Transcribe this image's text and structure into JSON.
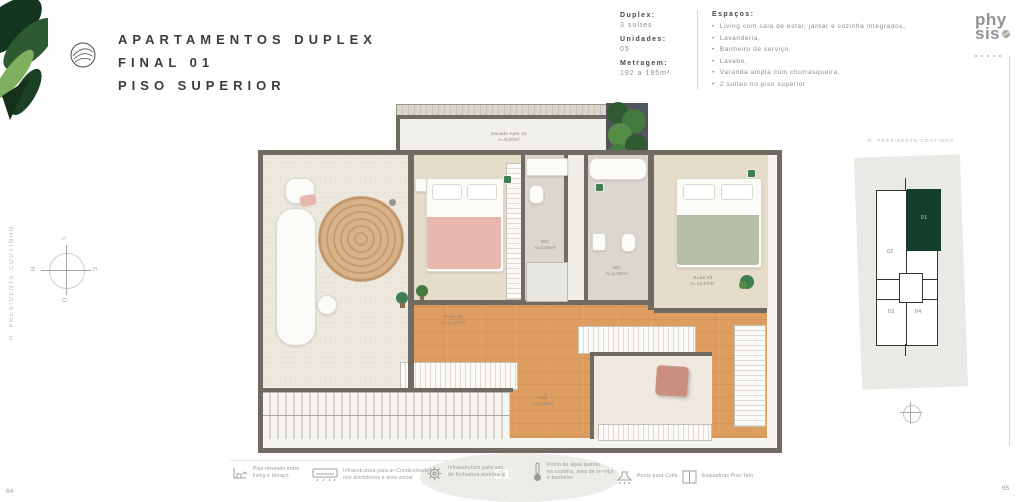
{
  "page": {
    "left_number": "64",
    "right_number": "65"
  },
  "header": {
    "title_line1": "APARTAMENTOS DUPLEX",
    "title_line2": "FINAL 01",
    "title_line3": "PISO SUPERIOR"
  },
  "specs": [
    {
      "label": "Duplex:",
      "value": "3 suítes"
    },
    {
      "label": "Unidades:",
      "value": "05"
    },
    {
      "label": "Metragem:",
      "value": "192 a 195m²"
    }
  ],
  "spaces": {
    "heading": "Espaços:",
    "items": [
      "Living com sala de estar, jantar e cozinha integrados,",
      "Lavanderia,",
      "Banheiro de serviço,",
      "Lavabo,",
      "Varanda ampla com churrasqueira,",
      "2 suítes no piso superior"
    ]
  },
  "logo": {
    "line1": "phy",
    "line2": "sis"
  },
  "street": {
    "name": "R. PRESIDENTE COUTINHO"
  },
  "compass": {
    "top": "L",
    "left": "N",
    "right": "S",
    "bottom": "O"
  },
  "floorplan": {
    "balcony": {
      "l1": "Sacada Apto 01",
      "l2": "A=9,00m²"
    },
    "suite02": {
      "l1": "Suíte 02",
      "l2": "A=17,07m²"
    },
    "suite03": {
      "l1": "Suíte 03",
      "l2": "A=12,07m²"
    },
    "wc1": {
      "l1": "WC",
      "l2": "A=3,06m²"
    },
    "wc2": {
      "l1": "WC",
      "l2": "A=4,06m²"
    },
    "hall": {
      "l1": "Hall",
      "l2": "A=2,06m²"
    }
  },
  "keyplan": {
    "street_label": "R. PRESIDENTE COUTINHO",
    "units": [
      "02",
      "01",
      "03",
      "04"
    ],
    "highlight_color": "#12402b"
  },
  "legend": {
    "items": [
      {
        "icon": "level-icon",
        "line1": "Piso nivelado entre",
        "line2": "living e terraço",
        "line3": ""
      },
      {
        "icon": "ac-icon",
        "line1": "Infraestrutura para ar-Condicionado",
        "line2": "nos dormitórios e área social",
        "line3": ""
      },
      {
        "icon": "gear-icon",
        "line1": "Infraestrutura para uso",
        "line2": "de fechadura eletrônica",
        "line3": ""
      },
      {
        "icon": "thermometer-icon",
        "line1": "Ponto de água quente",
        "line2": "na cozinha, área de serviço",
        "line3": "e banheiro"
      },
      {
        "icon": "hood-icon",
        "line1": "Ponto para Coifa",
        "line2": "",
        "line3": ""
      },
      {
        "icon": "window-icon",
        "line1": "Esquadrias Piso-Teto",
        "line2": "",
        "line3": ""
      }
    ]
  },
  "overlay": {
    "glyph_left": "51",
    "glyph_right": "+"
  },
  "colors": {
    "accent_green": "#12402b",
    "wood": "#dd9c60",
    "wall": "#6f6b63",
    "plant_green": "#3f7d52"
  }
}
